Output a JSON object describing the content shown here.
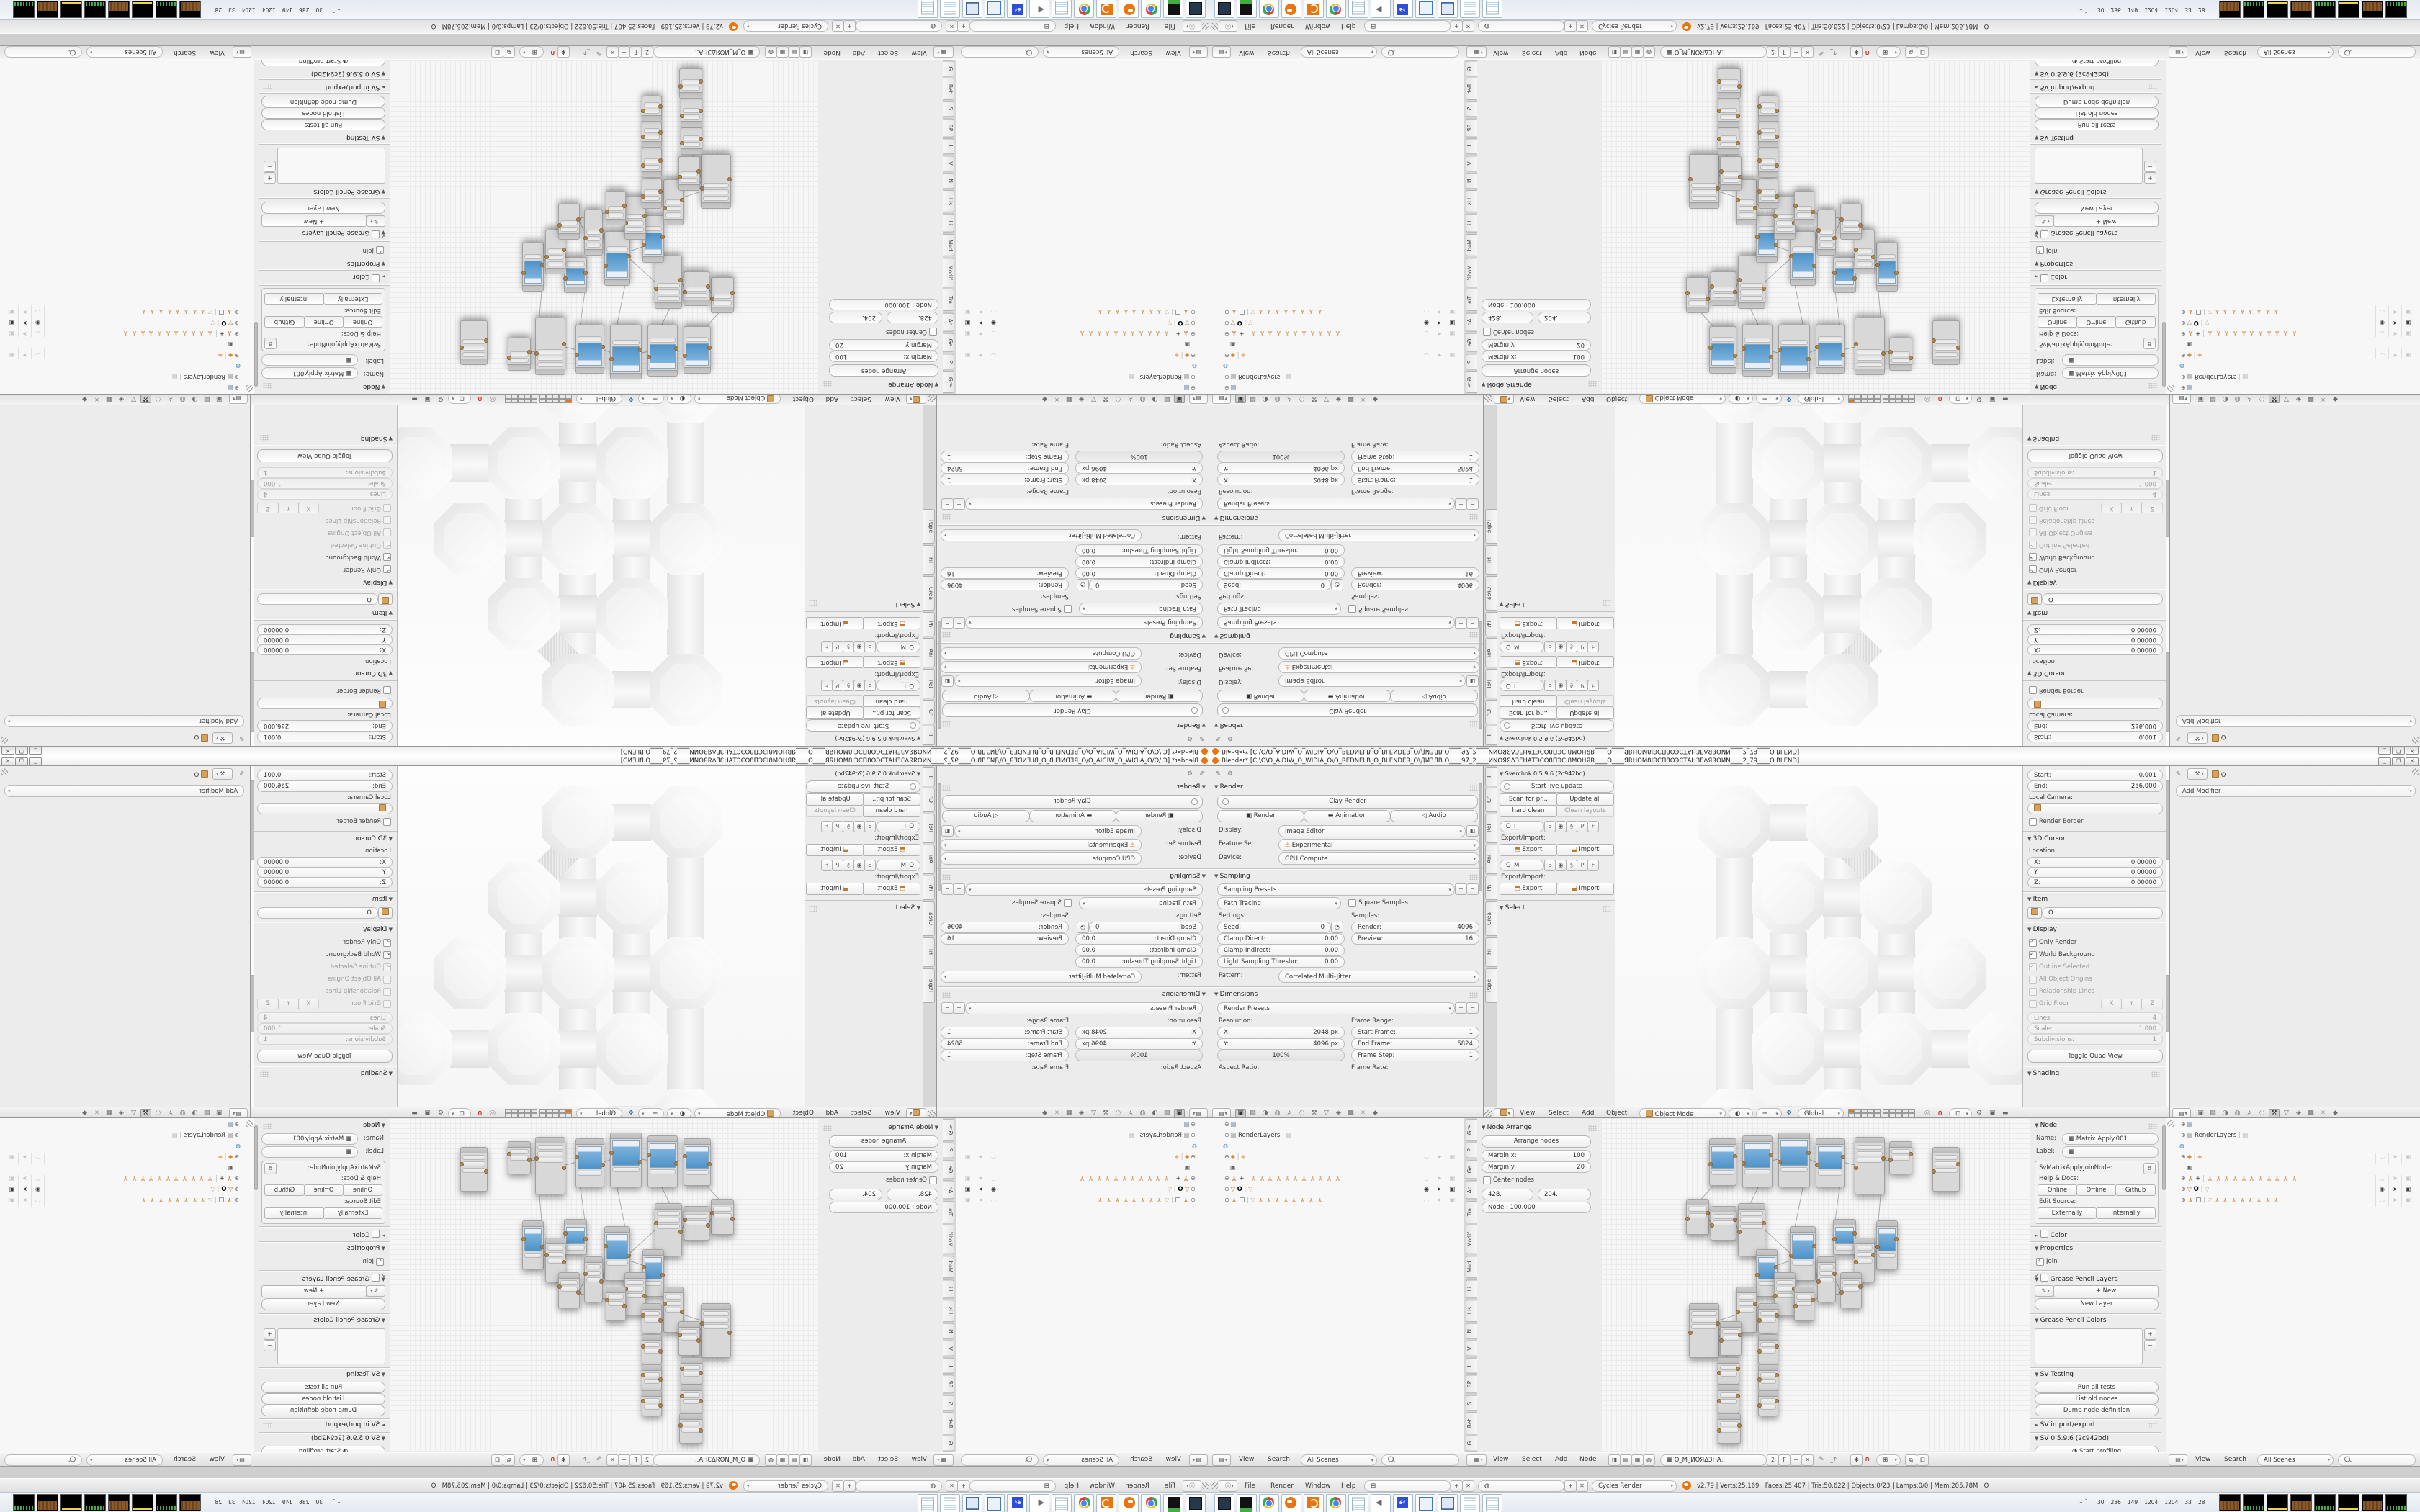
{
  "window": {
    "title": "Blender* [C:\\O\\O_AIDIW_O_WIDIA_O\\O_REDNELB_O_BLENDER_O\\ДИЗЛB.O____97_2____ИNОЯЯΔЗЕНАТЭСО8ПЭCI8МОНЯR____O____ЯRНОМ8IЭСП8ОЭСТАНЗЕΔЯROИN____2_79____O.BLEND]",
    "minimize": "_",
    "restore": "❐",
    "close": "✕"
  },
  "colors": {
    "accent_orange": "#e8750d",
    "preview_blue": "#4f93c8",
    "header_grey": "#e0e0e0"
  },
  "props_render": {
    "panel_render": "Render",
    "clay_render": "Clay Render",
    "btn_render": "Render",
    "btn_animation": "Animation",
    "btn_audio": "Audio",
    "display_label": "Display:",
    "display_value": "Image Editor",
    "feature_label": "Feature Set:",
    "feature_value": "Experimental",
    "device_label": "Device:",
    "device_value": "GPU Compute",
    "panel_sampling": "Sampling",
    "sampling_presets": "Sampling Presets",
    "integrator": "Path Tracing",
    "square_samples": "Square Samples",
    "settings_label": "Settings:",
    "samples_label": "Samples:",
    "seed_label": "Seed:",
    "seed_value": "0",
    "clamp_direct_label": "Clamp Direct:",
    "clamp_direct_value": "0.00",
    "clamp_indirect_label": "Clamp Indirect:",
    "clamp_indirect_value": "0.00",
    "light_thresh_label": "Light Sampling Thresho:",
    "light_thresh_value": "0.00",
    "render_samples_label": "Render:",
    "render_samples_value": "4096",
    "preview_samples_label": "Preview:",
    "preview_samples_value": "16",
    "pattern_label": "Pattern:",
    "pattern_value": "Correlated Multi-Jitter",
    "panel_dimensions": "Dimensions",
    "render_presets": "Render Presets",
    "resolution_label": "Resolution:",
    "frame_range_label": "Frame Range:",
    "res_x_label": "X:",
    "res_x_value": "2048 px",
    "res_y_label": "Y:",
    "res_y_value": "4096 px",
    "res_pct": "100%",
    "start_frame_label": "Start Frame:",
    "start_frame_value": "1",
    "end_frame_label": "End Frame:",
    "end_frame_value": "5824",
    "frame_step_label": "Frame Step:",
    "frame_step_value": "1",
    "aspect_label": "Aspect Ratio:",
    "frame_rate_label": "Frame Rate:"
  },
  "viewport": {
    "tshelf_tabs": [
      "T",
      "Cr",
      "Rel",
      "Ani",
      "Ph",
      "Grea",
      "Fil",
      "Pape"
    ],
    "sv_panel": "Sverchok 0.5.9.6 (2c942bd)",
    "start_live_update": "Start live update",
    "scan_props": "Scan for pr...",
    "update_all": "Update all",
    "hard_clean": "hard clean",
    "clean_layouts": "Clean layouts",
    "layer_box_1": "O_I_",
    "layer_box_2": "O_M",
    "layer_buttons": [
      "B",
      "P",
      "F"
    ],
    "export_import_label": "Export/Import:",
    "export_btn": "Export",
    "import_btn": "Import",
    "panel_select": "Select",
    "header_menus": [
      "View",
      "Select",
      "Add",
      "Object"
    ],
    "mode": "Object Mode",
    "orientation": "Global",
    "n": {
      "start_label": "Start:",
      "start_value": "0.001",
      "end_label": "End:",
      "end_value": "256.000",
      "local_camera": "Local Camera:",
      "render_border": "Render Border",
      "panel_cursor": "3D Cursor",
      "location_label": "Location:",
      "x_label": "X:",
      "x_value": "0.00000",
      "y_label": "Y:",
      "y_value": "0.00000",
      "z_label": "Z:",
      "z_value": "0.00000",
      "panel_item": "Item",
      "item_name": "O",
      "panel_display": "Display",
      "only_render": "Only Render",
      "world_background": "World Background",
      "outline_selected": "Outline Selected",
      "all_object_origins": "All Object Origins",
      "relationship_lines": "Relationship Lines",
      "grid_floor": "Grid Floor",
      "axes": [
        "X",
        "Y",
        "Z"
      ],
      "lines_label": "Lines:",
      "lines_value": "4",
      "scale_label": "Scale:",
      "scale_value": "1.000",
      "subdiv_label": "Subdivisions:",
      "subdiv_value": "1",
      "toggle_quad": "Toggle Quad View",
      "panel_shading": "Shading"
    }
  },
  "props_modifier": {
    "object_name": "O",
    "add_modifier": "Add Modifier"
  },
  "node_editor": {
    "tabs": [
      "Gre",
      "P",
      "Ge",
      "An",
      "Tra",
      "Modif",
      "Mod",
      "Li",
      "Lis",
      "N",
      "V",
      "L",
      "BP",
      "S",
      "Bet",
      "G"
    ],
    "panel_arrange": "Node Arrange",
    "arrange_nodes": "Arrange nodes",
    "margin_x_label": "Margin x:",
    "margin_x_value": "100",
    "margin_y_label": "Margin y:",
    "margin_y_value": "20",
    "center_nodes": "Center nodes",
    "btn_left": "428.",
    "btn_right": "204.",
    "node_dist": "Node : 100.000",
    "header_menus": [
      "View",
      "Select",
      "Add",
      "Node"
    ],
    "tree_name": "O_M_ИОЯΔЗНА...",
    "tree_users": "2",
    "fake_user": "F",
    "n": {
      "panel_node": "Node",
      "name_label": "Name:",
      "name_value": "Matrix Apply.001",
      "label_label": "Label:",
      "idname": "SvMatrixApplyJoinNode:",
      "help_docs": "Help & Docs:",
      "online": "Online",
      "offline": "Offline",
      "github": "Github",
      "edit_source": "Edit Source:",
      "externally": "Externally",
      "internally": "Internally",
      "panel_color": "Color",
      "panel_properties": "Properties",
      "join": "Join",
      "panel_gp_layers": "Grease Pencil Layers",
      "new_btn": "New",
      "new_layer_btn": "New Layer",
      "panel_gp_colors": "Grease Pencil Colors",
      "panel_sv_testing": "SV Testing",
      "run_all_tests": "Run all tests",
      "list_old_nodes": "List old nodes",
      "dump_node_definition": "Dump node definition",
      "panel_sv_import_export": "SV import/export",
      "panel_sv_version": "SV 0.5.9.6 (2c942bd)",
      "start_profiling": "Start profiling"
    }
  },
  "outliner": {
    "header_menus": [
      "View",
      "Search"
    ],
    "display_mode": "All Scenes",
    "items": [
      {
        "icon": "screen",
        "label": "",
        "expand": true,
        "restrict": false
      },
      {
        "icon": "renderlayers",
        "label": "RenderLayers",
        "expand": true,
        "pipe": [
          "renderlayers"
        ],
        "restrict": false
      },
      {
        "icon": "world",
        "label": "",
        "expand": false,
        "restrict": false
      },
      {
        "icon": "group",
        "label": "",
        "expand": true,
        "pipe": [
          "group"
        ],
        "restrict": true
      },
      {
        "icon": "camera",
        "label": "",
        "expand": false,
        "indent": 2,
        "restrict": false
      },
      {
        "icon": "empty",
        "label": "+",
        "expand": true,
        "empties": 11,
        "restrict": true
      },
      {
        "icon": "mesh",
        "label": "O",
        "expand": true,
        "meshes": 1,
        "restrict": true,
        "selected": true
      },
      {
        "icon": "empty",
        "label": "□",
        "expand": true,
        "meshes": 1,
        "empties": 8,
        "restrict": true
      }
    ]
  },
  "info_bar": {
    "menus": [
      "File",
      "Render",
      "Window",
      "Help"
    ],
    "engine": "Cycles Render",
    "stats": "v2.79 | Verts:25,169 | Faces:25,407 | Tris:50,622 | Objects:0/23 | Lamps:0/0 | Mem:205.78M | O"
  },
  "taskbar": {
    "icons": [
      "screen-capture",
      "removable-drive",
      "chrome",
      "blender",
      "spiral-app",
      "chrome-2",
      "notepad",
      "volume",
      "floppy-64",
      "image-viewer",
      "calculator",
      "notepad-2",
      "notepad-3"
    ],
    "floppy_label": "64",
    "tray_numbers": [
      "30",
      "286",
      "149",
      "1204",
      "1204",
      "33",
      "28"
    ],
    "tray_graph_count": 8
  }
}
